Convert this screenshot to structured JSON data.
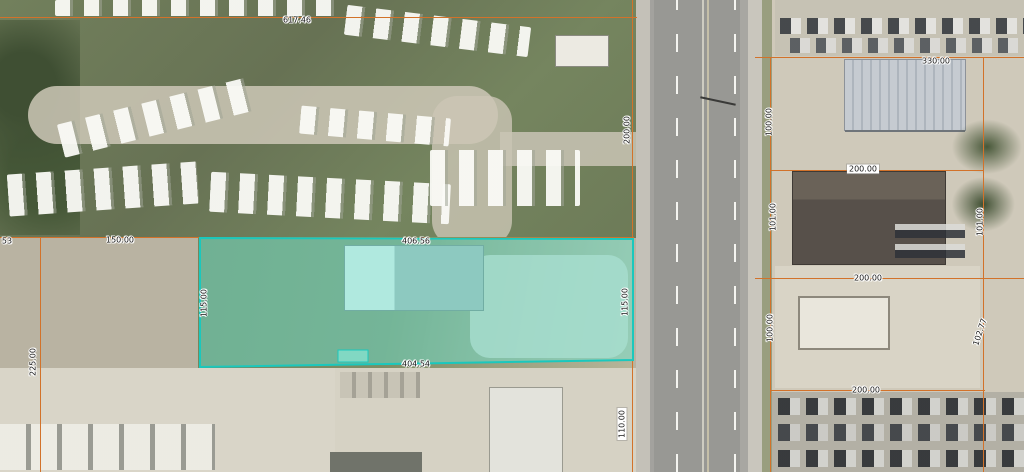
{
  "map": {
    "type": "aerial-parcel-view",
    "colors": {
      "parcel_line": "#d2722a",
      "highlight_stroke": "#1ac8bd",
      "highlight_fill": "rgba(106,238,224,0.42)",
      "label_text": "#1a1a1a",
      "label_halo": "#ffffff"
    },
    "dimension_labels": [
      {
        "text": "617.46",
        "x": 297,
        "y": 20,
        "rot": 0,
        "boxed": false
      },
      {
        "text": "330.00",
        "x": 936,
        "y": 61,
        "rot": 0,
        "boxed": false
      },
      {
        "text": "200.00",
        "x": 627,
        "y": 130,
        "rot": -90,
        "boxed": false
      },
      {
        "text": "53",
        "x": 7,
        "y": 241,
        "rot": 0,
        "boxed": false
      },
      {
        "text": "150.00",
        "x": 120,
        "y": 240,
        "rot": 0,
        "boxed": false
      },
      {
        "text": "406.56",
        "x": 416,
        "y": 241,
        "rot": 0,
        "boxed": false
      },
      {
        "text": "404.54",
        "x": 416,
        "y": 364,
        "rot": 0,
        "boxed": false
      },
      {
        "text": "115.00",
        "x": 204,
        "y": 303,
        "rot": -90,
        "boxed": false
      },
      {
        "text": "115.00",
        "x": 625,
        "y": 302,
        "rot": -90,
        "boxed": false
      },
      {
        "text": "225.00",
        "x": 33,
        "y": 362,
        "rot": -90,
        "boxed": false
      },
      {
        "text": "100.00",
        "x": 769,
        "y": 122,
        "rot": -90,
        "boxed": false
      },
      {
        "text": "200.00",
        "x": 863,
        "y": 169,
        "rot": 0,
        "boxed": true
      },
      {
        "text": "101.00",
        "x": 773,
        "y": 217,
        "rot": -90,
        "boxed": false
      },
      {
        "text": "101.00",
        "x": 980,
        "y": 222,
        "rot": -90,
        "boxed": false
      },
      {
        "text": "200.00",
        "x": 868,
        "y": 278,
        "rot": 0,
        "boxed": false
      },
      {
        "text": "100.00",
        "x": 770,
        "y": 328,
        "rot": -90,
        "boxed": false
      },
      {
        "text": "102.77",
        "x": 980,
        "y": 332,
        "rot": -72,
        "boxed": false
      },
      {
        "text": "200.00",
        "x": 866,
        "y": 390,
        "rot": 0,
        "boxed": false
      },
      {
        "text": "110.00",
        "x": 622,
        "y": 424,
        "rot": -90,
        "boxed": true
      }
    ],
    "parcel_lines": [
      {
        "x": 0,
        "y": 17,
        "w": 637,
        "h": 1
      },
      {
        "x": 0,
        "y": 237,
        "w": 634,
        "h": 1
      },
      {
        "x": 632,
        "y": 0,
        "w": 1,
        "h": 472
      },
      {
        "x": 40,
        "y": 237,
        "w": 1,
        "h": 235
      },
      {
        "x": 755,
        "y": 57,
        "w": 269,
        "h": 1
      },
      {
        "x": 770,
        "y": 57,
        "w": 1,
        "h": 415
      },
      {
        "x": 983,
        "y": 57,
        "w": 1,
        "h": 415
      },
      {
        "x": 770,
        "y": 170,
        "w": 213,
        "h": 1
      },
      {
        "x": 755,
        "y": 278,
        "w": 269,
        "h": 1
      },
      {
        "x": 770,
        "y": 390,
        "w": 215,
        "h": 1
      }
    ],
    "selected_parcel": {
      "polygon": "200,238 633,239 633,360 200,367",
      "sub_rect": {
        "x": 338,
        "y": 350,
        "w": 30,
        "h": 12
      }
    }
  }
}
